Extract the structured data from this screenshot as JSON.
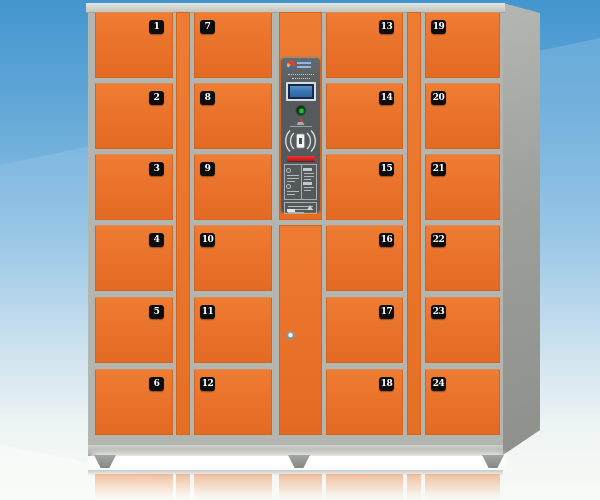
{
  "title": "24-door electronic storage locker cabinet",
  "background": {
    "sky_top": "#4496cf",
    "sky_bottom": "#f8faf6"
  },
  "cabinet": {
    "frame_color": "#b3b5b1",
    "door_color": "#e97129",
    "plate_color": "#0c0c0c",
    "plate_text_color": "#ffffff",
    "columns": [
      {
        "name": "column-1",
        "plate_side": "right",
        "doors": [
          "1",
          "2",
          "3",
          "4",
          "5",
          "6"
        ]
      },
      {
        "name": "column-2",
        "plate_side": "left",
        "doors": [
          "7",
          "8",
          "9",
          "10",
          "11",
          "12"
        ]
      },
      {
        "name": "column-3",
        "plate_side": "right",
        "doors": [
          "13",
          "14",
          "15",
          "16",
          "17",
          "18"
        ]
      },
      {
        "name": "column-4",
        "plate_side": "left",
        "doors": [
          "19",
          "20",
          "21",
          "22",
          "23",
          "24"
        ]
      }
    ],
    "control_panel": {
      "panel_color": "#565b5e",
      "lcd_color": "#3a76b4",
      "indicator_color": "#2dbb33",
      "slot_color": "#e02020",
      "elements": [
        "brand-logo",
        "lcd-display",
        "power-indicator-button",
        "sensor",
        "rfid-card-reader",
        "ticket-slot",
        "instruction-label",
        "spec-label"
      ]
    }
  }
}
